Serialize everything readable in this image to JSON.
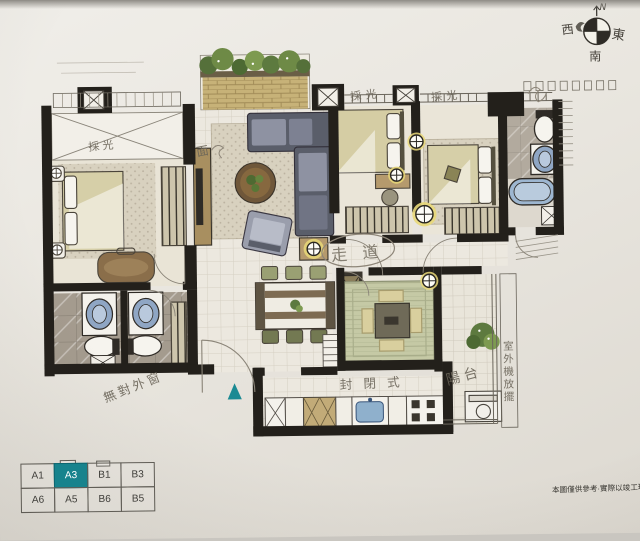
{
  "compass": {
    "north": "N",
    "west": "西",
    "south": "南",
    "east": "東"
  },
  "plan_annotations": {
    "daylight_left": "採光",
    "daylight_mid": "採光",
    "daylight_right": "採光",
    "face_note": "面",
    "corridor": "走道",
    "no_exterior_window": "無對外窗",
    "closed_style": "封閉式",
    "balcony": "陽台",
    "outdoor_unit_note": "室外機放擺"
  },
  "unit_selector": {
    "cells": [
      [
        "A1",
        "A3",
        "B1",
        "B3"
      ],
      [
        "A6",
        "A5",
        "B6",
        "B5"
      ]
    ],
    "selected": "A3",
    "selected_color": "#17838d"
  },
  "disclaimer": "本圖僅供參考·實際以竣工現況為準",
  "colors": {
    "accent_teal": "#17838d",
    "wall": "#23201b",
    "pencil": "#6b6559"
  }
}
